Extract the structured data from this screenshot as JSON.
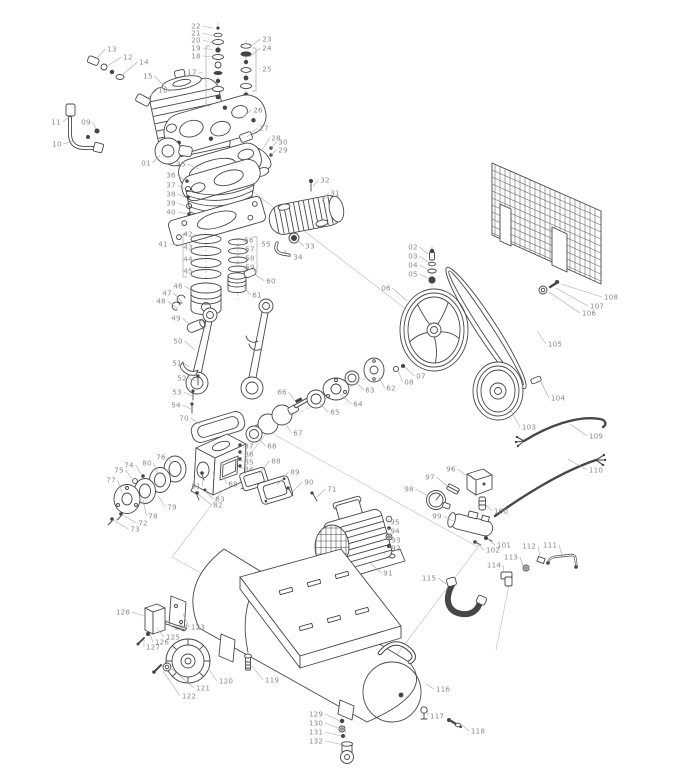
{
  "figure": {
    "kind": "exploded-parts-diagram",
    "subject": "belt-driven air compressor"
  },
  "style": {
    "background": "#ffffff",
    "art_line": "#474747",
    "leader_line": "#a8a8a8",
    "label_text": "#8a8a8a",
    "label_font_size": 7.2
  },
  "parts": [
    {
      "n": "01",
      "lx": 146,
      "ly": 163,
      "tx": 160,
      "ty": 155
    },
    {
      "n": "02",
      "lx": 413,
      "ly": 247,
      "tx": 428,
      "ty": 254
    },
    {
      "n": "03",
      "lx": 413,
      "ly": 256,
      "tx": 429,
      "ty": 263
    },
    {
      "n": "04",
      "lx": 413,
      "ly": 265,
      "tx": 429,
      "ty": 270
    },
    {
      "n": "05",
      "lx": 413,
      "ly": 274,
      "tx": 429,
      "ty": 279
    },
    {
      "n": "06",
      "lx": 386,
      "ly": 288,
      "tx": 407,
      "ty": 301
    },
    {
      "n": "07",
      "lx": 421,
      "ly": 376,
      "tx": 405,
      "ty": 367
    },
    {
      "n": "08",
      "lx": 409,
      "ly": 382,
      "tx": 398,
      "ty": 370
    },
    {
      "n": "09",
      "lx": 86,
      "ly": 122,
      "tx": 96,
      "ty": 129
    },
    {
      "n": "10",
      "lx": 57,
      "ly": 144,
      "tx": 72,
      "ty": 141
    },
    {
      "n": "11",
      "lx": 56,
      "ly": 122,
      "tx": 69,
      "ty": 117
    },
    {
      "n": "12",
      "lx": 128,
      "ly": 57,
      "tx": 107,
      "ty": 66
    },
    {
      "n": "13",
      "lx": 112,
      "ly": 49,
      "tx": 96,
      "ty": 59
    },
    {
      "n": "14",
      "lx": 144,
      "ly": 62,
      "tx": 122,
      "ty": 75
    },
    {
      "n": "15",
      "lx": 148,
      "ly": 76,
      "tx": 170,
      "ty": 92
    },
    {
      "n": "16",
      "lx": 163,
      "ly": 90,
      "tx": 147,
      "ty": 99
    },
    {
      "n": "17",
      "lx": 192,
      "ly": 72,
      "tx": 203,
      "ty": 73
    },
    {
      "n": "18",
      "lx": 196,
      "ly": 56,
      "tx": 213,
      "ty": 57
    },
    {
      "n": "19",
      "lx": 196,
      "ly": 48,
      "tx": 213,
      "ty": 50
    },
    {
      "n": "20",
      "lx": 196,
      "ly": 40,
      "tx": 213,
      "ty": 43
    },
    {
      "n": "21",
      "lx": 196,
      "ly": 33,
      "tx": 213,
      "ty": 36
    },
    {
      "n": "22",
      "lx": 196,
      "ly": 26,
      "tx": 213,
      "ty": 28
    },
    {
      "n": "23",
      "lx": 267,
      "ly": 39,
      "tx": 250,
      "ty": 47
    },
    {
      "n": "24",
      "lx": 267,
      "ly": 48,
      "tx": 249,
      "ty": 57
    },
    {
      "n": "25",
      "lx": 267,
      "ly": 69,
      "tx": 259,
      "ty": 69
    },
    {
      "n": "26",
      "lx": 258,
      "ly": 110,
      "tx": 243,
      "ty": 117
    },
    {
      "n": "27",
      "lx": 264,
      "ly": 128,
      "tx": 247,
      "ty": 137
    },
    {
      "n": "28",
      "lx": 276,
      "ly": 138,
      "tx": 263,
      "ty": 149
    },
    {
      "n": "29",
      "lx": 283,
      "ly": 150,
      "tx": 271,
      "ty": 155
    },
    {
      "n": "30",
      "lx": 283,
      "ly": 142,
      "tx": 271,
      "ty": 148
    },
    {
      "n": "31",
      "lx": 335,
      "ly": 193,
      "tx": 322,
      "ty": 201
    },
    {
      "n": "32",
      "lx": 325,
      "ly": 180,
      "tx": 313,
      "ty": 186
    },
    {
      "n": "33",
      "lx": 310,
      "ly": 246,
      "tx": 296,
      "ty": 239
    },
    {
      "n": "34",
      "lx": 298,
      "ly": 257,
      "tx": 284,
      "ty": 250
    },
    {
      "n": "35",
      "lx": 181,
      "ly": 164,
      "tx": 198,
      "ty": 169
    },
    {
      "n": "36",
      "lx": 171,
      "ly": 175,
      "tx": 186,
      "ty": 181
    },
    {
      "n": "37",
      "lx": 171,
      "ly": 185,
      "tx": 187,
      "ty": 190
    },
    {
      "n": "38",
      "lx": 171,
      "ly": 194,
      "tx": 187,
      "ty": 198
    },
    {
      "n": "39",
      "lx": 171,
      "ly": 203,
      "tx": 188,
      "ty": 207
    },
    {
      "n": "40",
      "lx": 171,
      "ly": 212,
      "tx": 188,
      "ty": 214
    },
    {
      "n": "41",
      "lx": 163,
      "ly": 244,
      "tx": 180,
      "ty": 245
    },
    {
      "n": "42",
      "lx": 188,
      "ly": 234,
      "tx": 193,
      "ty": 238
    },
    {
      "n": "43",
      "lx": 188,
      "ly": 247,
      "tx": 193,
      "ty": 250
    },
    {
      "n": "44",
      "lx": 188,
      "ly": 259,
      "tx": 193,
      "ty": 262
    },
    {
      "n": "45",
      "lx": 188,
      "ly": 271,
      "tx": 193,
      "ty": 273
    },
    {
      "n": "46",
      "lx": 178,
      "ly": 286,
      "tx": 194,
      "ty": 292
    },
    {
      "n": "47",
      "lx": 167,
      "ly": 293,
      "tx": 182,
      "ty": 302
    },
    {
      "n": "48",
      "lx": 161,
      "ly": 301,
      "tx": 178,
      "ty": 309
    },
    {
      "n": "49",
      "lx": 176,
      "ly": 318,
      "tx": 189,
      "ty": 324
    },
    {
      "n": "50",
      "lx": 178,
      "ly": 341,
      "tx": 195,
      "ty": 350
    },
    {
      "n": "51",
      "lx": 177,
      "ly": 363,
      "tx": 189,
      "ty": 367
    },
    {
      "n": "52",
      "lx": 182,
      "ly": 378,
      "tx": 196,
      "ty": 381
    },
    {
      "n": "53",
      "lx": 177,
      "ly": 392,
      "tx": 192,
      "ty": 396
    },
    {
      "n": "54",
      "lx": 176,
      "ly": 405,
      "tx": 191,
      "ty": 409
    },
    {
      "n": "55",
      "lx": 266,
      "ly": 244,
      "tx": 259,
      "ty": 244
    },
    {
      "n": "56",
      "lx": 249,
      "ly": 240,
      "tx": 246,
      "ty": 242
    },
    {
      "n": "57",
      "lx": 250,
      "ly": 249,
      "tx": 246,
      "ty": 251
    },
    {
      "n": "58",
      "lx": 250,
      "ly": 258,
      "tx": 246,
      "ty": 260
    },
    {
      "n": "59",
      "lx": 250,
      "ly": 267,
      "tx": 246,
      "ty": 269
    },
    {
      "n": "60",
      "lx": 271,
      "ly": 281,
      "tx": 256,
      "ty": 275
    },
    {
      "n": "61",
      "lx": 257,
      "ly": 295,
      "tx": 244,
      "ty": 287
    },
    {
      "n": "62",
      "lx": 391,
      "ly": 388,
      "tx": 379,
      "ty": 377
    },
    {
      "n": "63",
      "lx": 370,
      "ly": 390,
      "tx": 355,
      "ty": 381
    },
    {
      "n": "64",
      "lx": 358,
      "ly": 404,
      "tx": 340,
      "ty": 394
    },
    {
      "n": "65",
      "lx": 335,
      "ly": 412,
      "tx": 319,
      "ty": 403
    },
    {
      "n": "66",
      "lx": 282,
      "ly": 392,
      "tx": 295,
      "ty": 401
    },
    {
      "n": "67",
      "lx": 298,
      "ly": 433,
      "tx": 285,
      "ty": 423
    },
    {
      "n": "68",
      "lx": 272,
      "ly": 446,
      "tx": 258,
      "ty": 438
    },
    {
      "n": "69",
      "lx": 233,
      "ly": 484,
      "tx": 224,
      "ty": 476
    },
    {
      "n": "70",
      "lx": 184,
      "ly": 418,
      "tx": 200,
      "ty": 424
    },
    {
      "n": "71",
      "lx": 332,
      "ly": 489,
      "tx": 317,
      "ty": 497
    },
    {
      "n": "72",
      "lx": 143,
      "ly": 523,
      "tx": 123,
      "ty": 515
    },
    {
      "n": "73",
      "lx": 135,
      "ly": 529,
      "tx": 113,
      "ty": 520
    },
    {
      "n": "74",
      "lx": 129,
      "ly": 465,
      "tx": 141,
      "ty": 474
    },
    {
      "n": "75",
      "lx": 119,
      "ly": 470,
      "tx": 133,
      "ty": 480
    },
    {
      "n": "76",
      "lx": 161,
      "ly": 457,
      "tx": 172,
      "ty": 464
    },
    {
      "n": "77",
      "lx": 111,
      "ly": 480,
      "tx": 122,
      "ty": 492
    },
    {
      "n": "78",
      "lx": 153,
      "ly": 516,
      "tx": 143,
      "ty": 500
    },
    {
      "n": "79",
      "lx": 172,
      "ly": 507,
      "tx": 158,
      "ty": 496
    },
    {
      "n": "80",
      "lx": 147,
      "ly": 463,
      "tx": 158,
      "ty": 474
    },
    {
      "n": "81",
      "lx": 196,
      "ly": 486,
      "tx": 203,
      "ty": 475
    },
    {
      "n": "82",
      "lx": 218,
      "ly": 505,
      "tx": 198,
      "ty": 494
    },
    {
      "n": "83",
      "lx": 220,
      "ly": 499,
      "tx": 205,
      "ty": 491
    },
    {
      "n": "84",
      "lx": 249,
      "ly": 469,
      "tx": 241,
      "ty": 466
    },
    {
      "n": "85",
      "lx": 249,
      "ly": 462,
      "tx": 241,
      "ty": 459
    },
    {
      "n": "86",
      "lx": 249,
      "ly": 454,
      "tx": 241,
      "ty": 452
    },
    {
      "n": "87",
      "lx": 249,
      "ly": 446,
      "tx": 241,
      "ty": 445
    },
    {
      "n": "88",
      "lx": 276,
      "ly": 461,
      "tx": 259,
      "ty": 474
    },
    {
      "n": "89",
      "lx": 295,
      "ly": 472,
      "tx": 277,
      "ty": 485
    },
    {
      "n": "90",
      "lx": 309,
      "ly": 482,
      "tx": 292,
      "ty": 492
    },
    {
      "n": "91",
      "lx": 388,
      "ly": 573,
      "tx": 370,
      "ty": 563
    },
    {
      "n": "92",
      "lx": 396,
      "ly": 548,
      "tx": 389,
      "ty": 546
    },
    {
      "n": "93",
      "lx": 396,
      "ly": 540,
      "tx": 389,
      "ty": 537
    },
    {
      "n": "94",
      "lx": 395,
      "ly": 531,
      "tx": 389,
      "ty": 528
    },
    {
      "n": "95",
      "lx": 395,
      "ly": 522,
      "tx": 389,
      "ty": 519
    },
    {
      "n": "96",
      "lx": 451,
      "ly": 469,
      "tx": 467,
      "ty": 476
    },
    {
      "n": "97",
      "lx": 430,
      "ly": 477,
      "tx": 448,
      "ty": 487
    },
    {
      "n": "98",
      "lx": 409,
      "ly": 489,
      "tx": 428,
      "ty": 496
    },
    {
      "n": "99",
      "lx": 437,
      "ly": 516,
      "tx": 453,
      "ty": 521
    },
    {
      "n": "100",
      "lx": 501,
      "ly": 511,
      "tx": 486,
      "ty": 505
    },
    {
      "n": "101",
      "lx": 504,
      "ly": 545,
      "tx": 488,
      "ty": 539
    },
    {
      "n": "102",
      "lx": 493,
      "ly": 550,
      "tx": 476,
      "ty": 543
    },
    {
      "n": "103",
      "lx": 529,
      "ly": 427,
      "tx": 510,
      "ty": 409
    },
    {
      "n": "104",
      "lx": 558,
      "ly": 398,
      "tx": 541,
      "ty": 382
    },
    {
      "n": "105",
      "lx": 555,
      "ly": 344,
      "tx": 537,
      "ty": 331
    },
    {
      "n": "106",
      "lx": 589,
      "ly": 313,
      "tx": 549,
      "ty": 292
    },
    {
      "n": "107",
      "lx": 597,
      "ly": 306,
      "tx": 556,
      "ty": 288
    },
    {
      "n": "108",
      "lx": 611,
      "ly": 297,
      "tx": 561,
      "ty": 284
    },
    {
      "n": "109",
      "lx": 596,
      "ly": 436,
      "tx": 570,
      "ty": 424
    },
    {
      "n": "110",
      "lx": 596,
      "ly": 470,
      "tx": 568,
      "ty": 459
    },
    {
      "n": "111",
      "lx": 550,
      "ly": 545,
      "tx": 562,
      "ty": 555
    },
    {
      "n": "112",
      "lx": 529,
      "ly": 546,
      "tx": 540,
      "ty": 557
    },
    {
      "n": "113",
      "lx": 511,
      "ly": 557,
      "tx": 523,
      "ty": 566
    },
    {
      "n": "114",
      "lx": 494,
      "ly": 565,
      "tx": 504,
      "ty": 573
    },
    {
      "n": "115",
      "lx": 429,
      "ly": 578,
      "tx": 446,
      "ty": 584
    },
    {
      "n": "116",
      "lx": 443,
      "ly": 689,
      "tx": 426,
      "ty": 684
    },
    {
      "n": "117",
      "lx": 437,
      "ly": 716,
      "tx": 428,
      "ty": 711
    },
    {
      "n": "118",
      "lx": 478,
      "ly": 731,
      "tx": 461,
      "ty": 724
    },
    {
      "n": "119",
      "lx": 272,
      "ly": 680,
      "tx": 252,
      "ty": 666
    },
    {
      "n": "120",
      "lx": 226,
      "ly": 681,
      "tx": 208,
      "ty": 668
    },
    {
      "n": "121",
      "lx": 203,
      "ly": 688,
      "tx": 172,
      "ty": 669
    },
    {
      "n": "122",
      "lx": 189,
      "ly": 696,
      "tx": 163,
      "ty": 671
    },
    {
      "n": "123",
      "lx": 198,
      "ly": 627,
      "tx": 183,
      "ty": 614
    },
    {
      "n": "124",
      "lx": 181,
      "ly": 627,
      "tx": 166,
      "ty": 620
    },
    {
      "n": "125",
      "lx": 173,
      "ly": 637,
      "tx": 157,
      "ty": 628
    },
    {
      "n": "126",
      "lx": 162,
      "ly": 642,
      "tx": 150,
      "ty": 634
    },
    {
      "n": "127",
      "lx": 153,
      "ly": 647,
      "tx": 144,
      "ty": 640
    },
    {
      "n": "128",
      "lx": 123,
      "ly": 612,
      "tx": 144,
      "ty": 616
    },
    {
      "n": "129",
      "lx": 316,
      "ly": 714,
      "tx": 340,
      "ty": 721
    },
    {
      "n": "130",
      "lx": 316,
      "ly": 723,
      "tx": 341,
      "ty": 729
    },
    {
      "n": "131",
      "lx": 316,
      "ly": 732,
      "tx": 341,
      "ty": 736
    },
    {
      "n": "132",
      "lx": 316,
      "ly": 741,
      "tx": 344,
      "ty": 745
    }
  ],
  "brackets": [
    {
      "n": "17",
      "x": 206,
      "y1": 46,
      "y2": 106,
      "dir": 1
    },
    {
      "n": "25",
      "x": 256,
      "y1": 48,
      "y2": 91,
      "dir": -1
    },
    {
      "n": "41",
      "x": 183,
      "y1": 234,
      "y2": 277,
      "dir": 1
    },
    {
      "n": "55",
      "x": 257,
      "y1": 237,
      "y2": 271,
      "dir": -1
    }
  ]
}
